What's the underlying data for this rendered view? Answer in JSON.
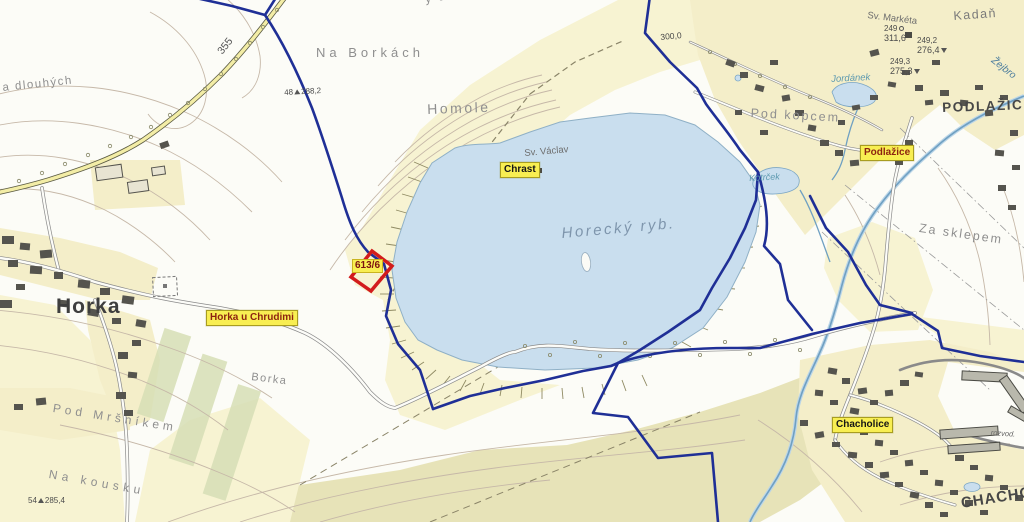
{
  "badges": {
    "chrast": "Chrast",
    "horka_u_chrudimi": "Horka u Chrudimi",
    "podlazice": "Podlažice",
    "chacholice": "Chacholice"
  },
  "parcel": {
    "number": "613/6",
    "outline_color": "#d21c1c"
  },
  "settlements": {
    "horka": "Horka",
    "podlazice_capital": "PODLAŽICE",
    "chacholice_capital": "CHACHOLICE",
    "kadan": "Kadaň"
  },
  "localities": {
    "na_borkach": "Na Borkách",
    "homole": "Homole",
    "u_homoli": "y u Homoli",
    "na_dlouhych": "a dlouhých",
    "pod_kopcem": "Pod kopcem",
    "za_sklepem": "Za sklepem",
    "pod_mrsnikem": "Pod Mršníkem",
    "na_kousku": "Na kousku",
    "borka": "Borka"
  },
  "water": {
    "lake": "Horecký ryb.",
    "pond": "Kotrček",
    "river": "Žejbro",
    "brook": "Jordánek"
  },
  "chapels": {
    "sv_vaclav": "Sv. Václav",
    "sv_marketa": "Sv. Markéta"
  },
  "roads": {
    "route_355": "355"
  },
  "elevations": {
    "pt288": {
      "id": "48",
      "value": "288,2"
    },
    "pt300": {
      "value": "300,0"
    },
    "pt311": {
      "id": "249",
      "value": "311,6"
    },
    "pt276": {
      "id": "249,2",
      "value": "276,4"
    },
    "pt275": {
      "id": "249,3",
      "value": "275,3"
    },
    "pt285": {
      "id": "54",
      "value": "285,4"
    }
  },
  "misc": {
    "rozvodna": "rozvod."
  },
  "colors": {
    "boundary_blue": "#1f2f96",
    "parcel_red": "#d21c1c",
    "badge_yellow": "#f8ee52",
    "lake_blue": "#c9deee",
    "field_yellow": "#f7f3d2",
    "olive_field": "#e7e3b8"
  }
}
